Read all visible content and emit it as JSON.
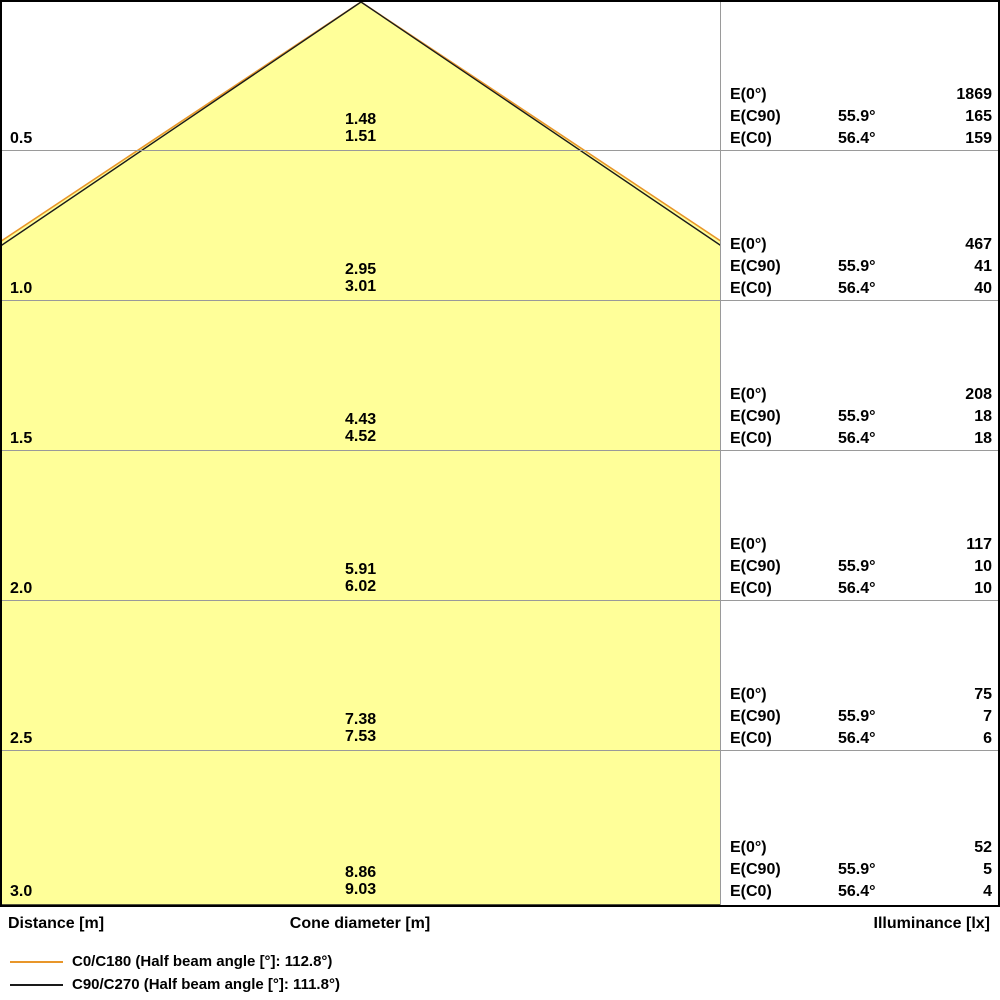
{
  "colors": {
    "cone_fill": "#FFFF99",
    "c0_line": "#E8962A",
    "c90_line": "#1A1A1A",
    "grid": "#9A9A9A",
    "border": "#000000"
  },
  "labels": {
    "e0": "E(0°)",
    "ec90": "E(C90)",
    "ec0": "E(C0)"
  },
  "rows": [
    {
      "distance": "0.5",
      "cone_c90": "1.48",
      "cone_c0": "1.51",
      "e0": "1869",
      "angle_c90": "55.9°",
      "ec90": "165",
      "angle_c0": "56.4°",
      "ec0": "159"
    },
    {
      "distance": "1.0",
      "cone_c90": "2.95",
      "cone_c0": "3.01",
      "e0": "467",
      "angle_c90": "55.9°",
      "ec90": "41",
      "angle_c0": "56.4°",
      "ec0": "40"
    },
    {
      "distance": "1.5",
      "cone_c90": "4.43",
      "cone_c0": "4.52",
      "e0": "208",
      "angle_c90": "55.9°",
      "ec90": "18",
      "angle_c0": "56.4°",
      "ec0": "18"
    },
    {
      "distance": "2.0",
      "cone_c90": "5.91",
      "cone_c0": "6.02",
      "e0": "117",
      "angle_c90": "55.9°",
      "ec90": "10",
      "angle_c0": "56.4°",
      "ec0": "10"
    },
    {
      "distance": "2.5",
      "cone_c90": "7.38",
      "cone_c0": "7.53",
      "e0": "75",
      "angle_c90": "55.9°",
      "ec90": "7",
      "angle_c0": "56.4°",
      "ec0": "6"
    },
    {
      "distance": "3.0",
      "cone_c90": "8.86",
      "cone_c0": "9.03",
      "e0": "52",
      "angle_c90": "55.9°",
      "ec90": "5",
      "angle_c0": "56.4°",
      "ec0": "4"
    }
  ],
  "footer": {
    "distance": "Distance [m]",
    "cone_diameter": "Cone diameter [m]",
    "illuminance": "Illuminance [lx]"
  },
  "legend": {
    "c0": "C0/C180 (Half beam angle [°]: 112.8°)",
    "c90": "C90/C270 (Half beam angle [°]: 111.8°)"
  },
  "chart_data": {
    "type": "area",
    "title": "Light cone diagram",
    "xlabel": "Distance [m]",
    "ylabel_mid": "Cone diameter [m]",
    "ylabel_right": "Illuminance [lx]",
    "x_distances_m": [
      0.5,
      1.0,
      1.5,
      2.0,
      2.5,
      3.0
    ],
    "series": [
      {
        "name": "C90/C270 cone diameter [m]",
        "values": [
          1.48,
          2.95,
          4.43,
          5.91,
          7.38,
          8.86
        ]
      },
      {
        "name": "C0/C180 cone diameter [m]",
        "values": [
          1.51,
          3.01,
          4.52,
          6.02,
          7.53,
          9.03
        ]
      },
      {
        "name": "E(0°) [lx]",
        "values": [
          1869,
          467,
          208,
          117,
          75,
          52
        ]
      },
      {
        "name": "E(C90) [lx]",
        "values": [
          165,
          41,
          18,
          10,
          7,
          5
        ]
      },
      {
        "name": "E(C0) [lx]",
        "values": [
          159,
          40,
          18,
          10,
          6,
          4
        ]
      }
    ],
    "half_beam_angle_c0_c180_deg": 112.8,
    "half_beam_angle_c90_c270_deg": 111.8,
    "half_angle_c90_deg": 55.9,
    "half_angle_c0_deg": 56.4,
    "legend": [
      "C0/C180 (Half beam angle [°]: 112.8°)",
      "C90/C270 (Half beam angle [°]: 111.8°)"
    ],
    "legend_position": "bottom-left",
    "grid": true
  }
}
